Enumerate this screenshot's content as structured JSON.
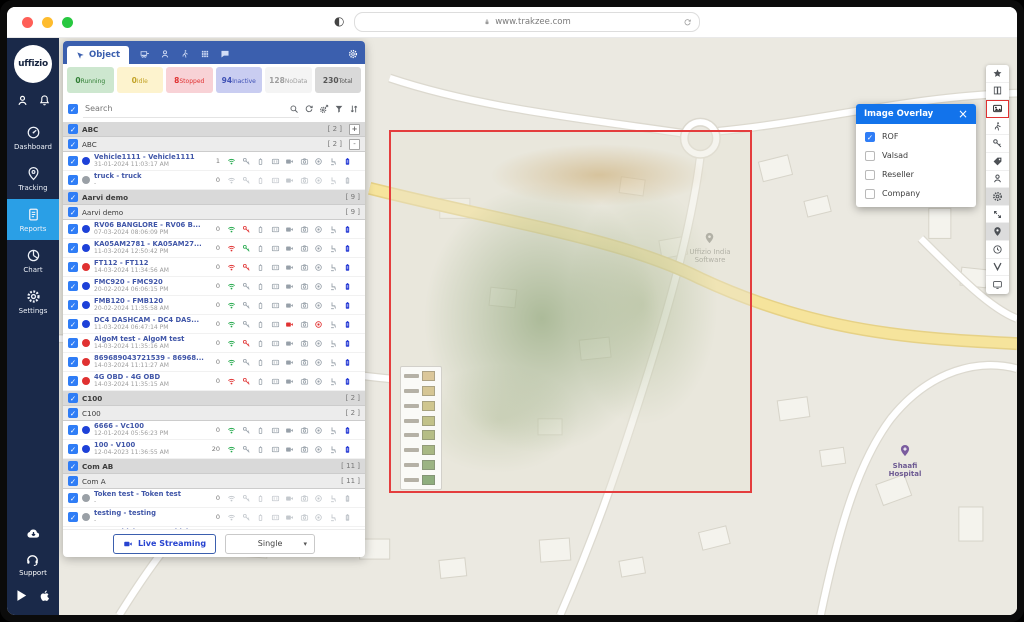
{
  "browser": {
    "url": "www.trakzee.com"
  },
  "sidebar": {
    "logo": "uffizio",
    "items": [
      {
        "label": "Dashboard",
        "icon": "speedometer"
      },
      {
        "label": "Tracking",
        "icon": "pin"
      },
      {
        "label": "Reports",
        "icon": "document",
        "active": true
      },
      {
        "label": "Chart",
        "icon": "pie"
      },
      {
        "label": "Settings",
        "icon": "gear"
      }
    ],
    "support_label": "Support"
  },
  "panel": {
    "active_tab": "Object",
    "header_icons": [
      "trailer-icon",
      "person-icon",
      "driver-icon",
      "grid-icon",
      "chat-icon",
      "gear-icon"
    ],
    "stats": [
      {
        "key": "running",
        "value": "0",
        "label": "Running"
      },
      {
        "key": "idle",
        "value": "0",
        "label": "Idle"
      },
      {
        "key": "stopped",
        "value": "8",
        "label": "Stopped"
      },
      {
        "key": "inactive",
        "value": "94",
        "label": "Inactive"
      },
      {
        "key": "nodata",
        "value": "128",
        "label": "NoData"
      },
      {
        "key": "total",
        "value": "230",
        "label": "Total"
      }
    ],
    "search_placeholder": "Search",
    "search_tools": [
      "search-icon",
      "refresh-icon",
      "gear-send-icon",
      "filter-icon",
      "sort-icon"
    ],
    "row_icons": [
      "signal",
      "key",
      "battery",
      "route",
      "video",
      "camera",
      "record",
      "seat",
      "device-battery"
    ],
    "footer": {
      "live_streaming": "Live Streaming",
      "mode": "Single"
    }
  },
  "list": [
    {
      "type": "group",
      "name": "ABC",
      "count": "[ 2 ]",
      "exp": "+"
    },
    {
      "type": "sub",
      "name": "ABC",
      "count": "[ 2 ]",
      "exp": "-"
    },
    {
      "type": "vehicle",
      "name": "Vehicle1111 - Vehicle1111",
      "date": "31-01-2024 11:03:17 AM",
      "count": "1",
      "dot": "blue",
      "wifi": "green",
      "key": "gray",
      "video": "gray",
      "record": "gray",
      "end": "blue"
    },
    {
      "type": "vehicle",
      "name": "truck - truck",
      "date": "-",
      "count": "0",
      "dot": "gray",
      "off": true
    },
    {
      "type": "group",
      "name": "Aarvi demo",
      "count": "[ 9 ]"
    },
    {
      "type": "sub",
      "name": "Aarvi demo",
      "count": "[ 9 ]"
    },
    {
      "type": "vehicle",
      "name": "RV06 BANGLORE - RV06 B...",
      "date": "07-03-2024 08:06:09 PM",
      "count": "0",
      "dot": "blue",
      "wifi": "green",
      "key": "red",
      "video": "gray",
      "record": "gray",
      "end": "blue"
    },
    {
      "type": "vehicle",
      "name": "KA05AM2781 - KA05AM27...",
      "date": "11-03-2024 12:50:42 PM",
      "count": "0",
      "dot": "blue",
      "wifi": "red",
      "key": "green",
      "video": "gray",
      "record": "gray",
      "end": "blue"
    },
    {
      "type": "vehicle",
      "name": "FT112 - FT112",
      "date": "14-03-2024 11:34:56 AM",
      "count": "0",
      "dot": "red",
      "wifi": "red",
      "key": "red",
      "video": "gray",
      "record": "gray",
      "end": "blue"
    },
    {
      "type": "vehicle",
      "name": "FMC920 - FMC920",
      "date": "20-02-2024 06:06:15 PM",
      "count": "0",
      "dot": "blue",
      "wifi": "green",
      "key": "gray",
      "video": "gray",
      "record": "gray",
      "end": "blue"
    },
    {
      "type": "vehicle",
      "name": "FMB120 - FMB120",
      "date": "20-02-2024 11:35:58 AM",
      "count": "0",
      "dot": "blue",
      "wifi": "green",
      "key": "gray",
      "video": "gray",
      "record": "gray",
      "end": "blue"
    },
    {
      "type": "vehicle",
      "name": "DC4 DASHCAM - DC4 DAS...",
      "date": "11-03-2024 06:47:14 PM",
      "count": "0",
      "dot": "blue",
      "wifi": "green",
      "key": "gray",
      "video": "red",
      "record": "red",
      "end": "blue"
    },
    {
      "type": "vehicle",
      "name": "AlgoM test - AlgoM test",
      "date": "14-03-2024 11:35:16 AM",
      "count": "0",
      "dot": "red",
      "wifi": "green",
      "key": "red",
      "video": "gray",
      "record": "gray",
      "end": "blue"
    },
    {
      "type": "vehicle",
      "name": "869689043721539 - 86968...",
      "date": "14-03-2024 11:11:27 AM",
      "count": "0",
      "dot": "red",
      "wifi": "green",
      "key": "gray",
      "video": "gray",
      "record": "gray",
      "end": "blue"
    },
    {
      "type": "vehicle",
      "name": "4G OBD - 4G OBD",
      "date": "14-03-2024 11:35:15 AM",
      "count": "0",
      "dot": "red",
      "wifi": "red",
      "key": "red",
      "video": "gray",
      "record": "gray",
      "end": "blue"
    },
    {
      "type": "group",
      "name": "C100",
      "count": "[ 2 ]"
    },
    {
      "type": "sub",
      "name": "C100",
      "count": "[ 2 ]"
    },
    {
      "type": "vehicle",
      "name": "6666 - Vc100",
      "date": "12-01-2024 05:56:23 PM",
      "count": "0",
      "dot": "blue",
      "wifi": "green",
      "key": "gray",
      "video": "gray",
      "record": "gray",
      "end": "blue"
    },
    {
      "type": "vehicle",
      "name": "100 - V100",
      "date": "12-04-2023 11:36:55 AM",
      "count": "20",
      "dot": "blue",
      "wifi": "green",
      "key": "gray",
      "video": "gray",
      "record": "gray",
      "end": "blue"
    },
    {
      "type": "group",
      "name": "Com AB",
      "count": "[ 11 ]"
    },
    {
      "type": "sub",
      "name": "Com A",
      "count": "[ 11 ]"
    },
    {
      "type": "vehicle",
      "name": "Token test - Token test",
      "date": "-",
      "count": "0",
      "dot": "gray",
      "off": true
    },
    {
      "type": "vehicle",
      "name": "testing - testing",
      "date": "-",
      "count": "0",
      "dot": "gray",
      "off": true
    },
    {
      "type": "vehicle",
      "name": "Test Vehicle - Test Vehicle",
      "date": "-",
      "count": "0",
      "dot": "gray",
      "off": true
    }
  ],
  "overlay_popup": {
    "title": "Image Overlay",
    "close": "×",
    "options": [
      {
        "label": "ROF",
        "checked": true
      },
      {
        "label": "Valsad",
        "checked": false
      },
      {
        "label": "Reseller",
        "checked": false
      },
      {
        "label": "Company",
        "checked": false
      }
    ]
  },
  "toolbar_right": {
    "items": [
      {
        "name": "favorites",
        "icon": "star"
      },
      {
        "name": "street-view",
        "icon": "book"
      },
      {
        "name": "image-overlay",
        "icon": "image",
        "active": true
      },
      {
        "name": "pedestrian",
        "icon": "walk"
      },
      {
        "name": "share-key",
        "icon": "key"
      },
      {
        "name": "label-tag",
        "icon": "tag"
      },
      {
        "name": "driver",
        "icon": "person"
      },
      {
        "name": "cluster-settings",
        "icon": "gear",
        "shaded": true
      },
      {
        "name": "expand-map",
        "icon": "expand"
      },
      {
        "name": "poi",
        "icon": "pinfill",
        "shaded": true
      },
      {
        "name": "history",
        "icon": "clock"
      },
      {
        "name": "traffic-route",
        "icon": "vroute"
      },
      {
        "name": "device-screen",
        "icon": "screen"
      }
    ]
  },
  "map": {
    "labels": [
      {
        "text": "Uffizio India Software"
      },
      {
        "text": "Shaafi Hospital"
      }
    ]
  }
}
